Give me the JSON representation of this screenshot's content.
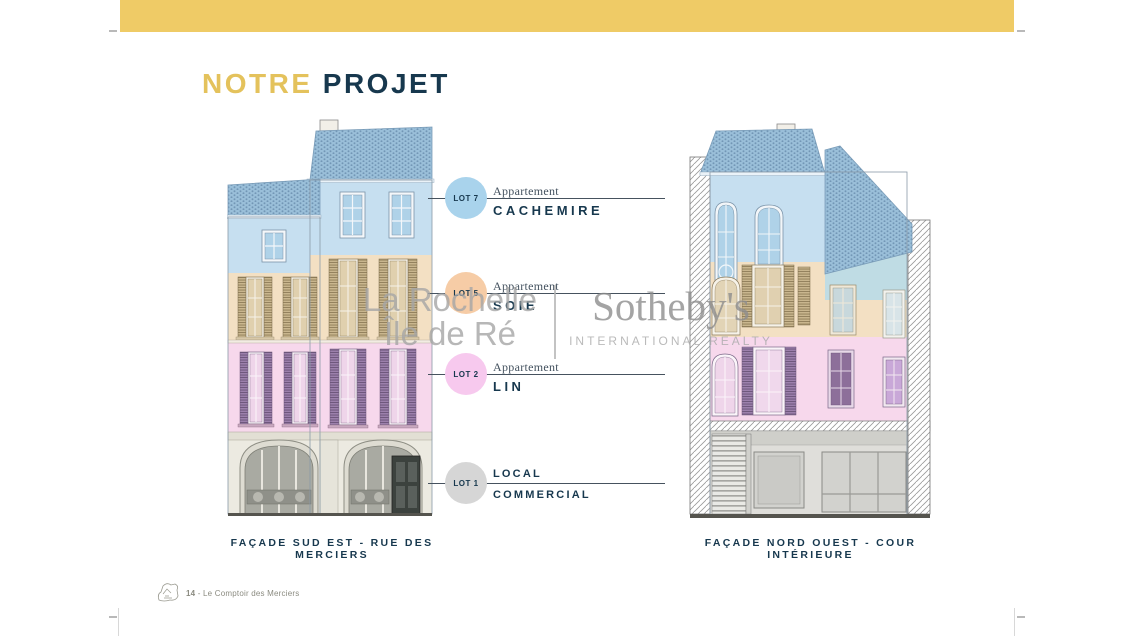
{
  "title": {
    "label_primary": "NOTRE",
    "label_secondary": "PROJET"
  },
  "lots": [
    {
      "badge": "LOT 7",
      "badge_color": "#A9D3EC",
      "category": "Appartement",
      "name": "CACHEMIRE"
    },
    {
      "badge": "LOT 5",
      "badge_color": "#F6CCA6",
      "category": "Appartement",
      "name": "SOIE"
    },
    {
      "badge": "LOT 2",
      "badge_color": "#F7C9EE",
      "category": "Appartement",
      "name": "LIN"
    },
    {
      "badge": "LOT 1",
      "badge_color": "#D6D6D6",
      "category": "LOCAL",
      "name": "COMMERCIAL"
    }
  ],
  "facades": [
    {
      "caption": "FAÇADE SUD EST - RUE DES MERCIERS"
    },
    {
      "caption": "FAÇADE NORD OUEST - COUR INTÉRIEURE"
    }
  ],
  "watermark": {
    "location_line1": "La Rochelle",
    "location_line2": "Île de Ré",
    "brand": "Sotheby's",
    "brand_subtitle": "INTERNATIONAL REALTY"
  },
  "footer": {
    "page_number": "14",
    "separator": " - ",
    "document_title": "Le Comptoir des Merciers"
  },
  "icons": {
    "footer_logo": "house-sketch-icon"
  },
  "colors": {
    "top_bar": "#EFCB66",
    "title_gold": "#E4C25C",
    "title_navy": "#17384E",
    "band_blue": "#C6DFF0",
    "band_beige": "#F3E0C3",
    "band_pink": "#F7D8EC",
    "ground_stone": "#ECEAE1",
    "roof_blue": "#9ABFD9",
    "shutter_purple": "#9C80AC",
    "shutter_tan": "#C9B68E",
    "watermark_gray": "#a6a6a6"
  }
}
